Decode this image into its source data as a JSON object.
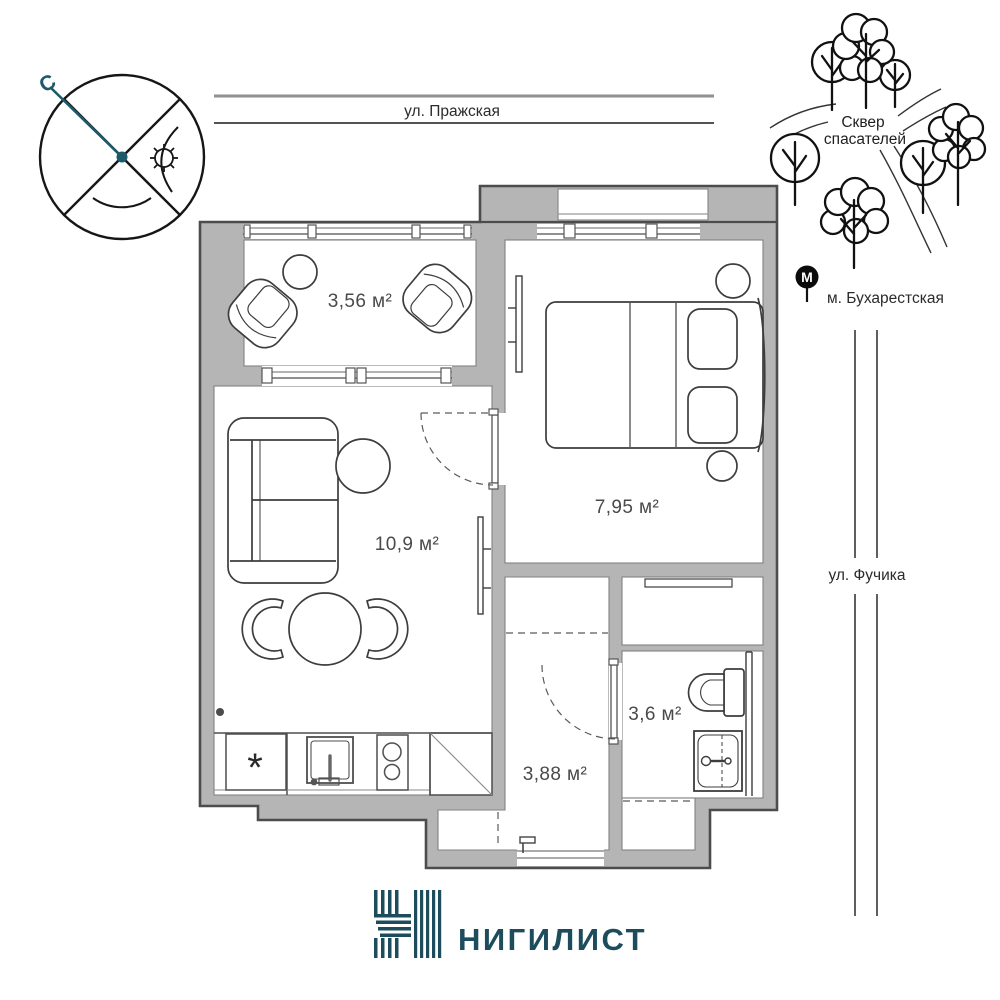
{
  "compass": {
    "north": "С"
  },
  "streets": {
    "top": "ул. Пражская",
    "right": "ул. Фучика"
  },
  "park": {
    "line1": "Сквер",
    "line2": "спасателей"
  },
  "metro": {
    "letter": "М",
    "station": "м. Бухарестская"
  },
  "rooms": {
    "balcony": {
      "area": "3,56 м²"
    },
    "living": {
      "area": "10,9 м²"
    },
    "bedroom": {
      "area": "7,95 м²"
    },
    "bathroom": {
      "area": "3,6 м²"
    },
    "hallway": {
      "area": "3,88 м²"
    }
  },
  "kitchen": {
    "freezer_mark": "*"
  },
  "brand": {
    "name": "НИГИЛИСТ"
  },
  "colors": {
    "brand_teal": "#1d4d5c",
    "compass_teal": "#1b5a6b",
    "wall_fill": "#b5b5b5",
    "wall_stroke": "#4c4c4c",
    "label_gray": "#4a4a4a"
  }
}
